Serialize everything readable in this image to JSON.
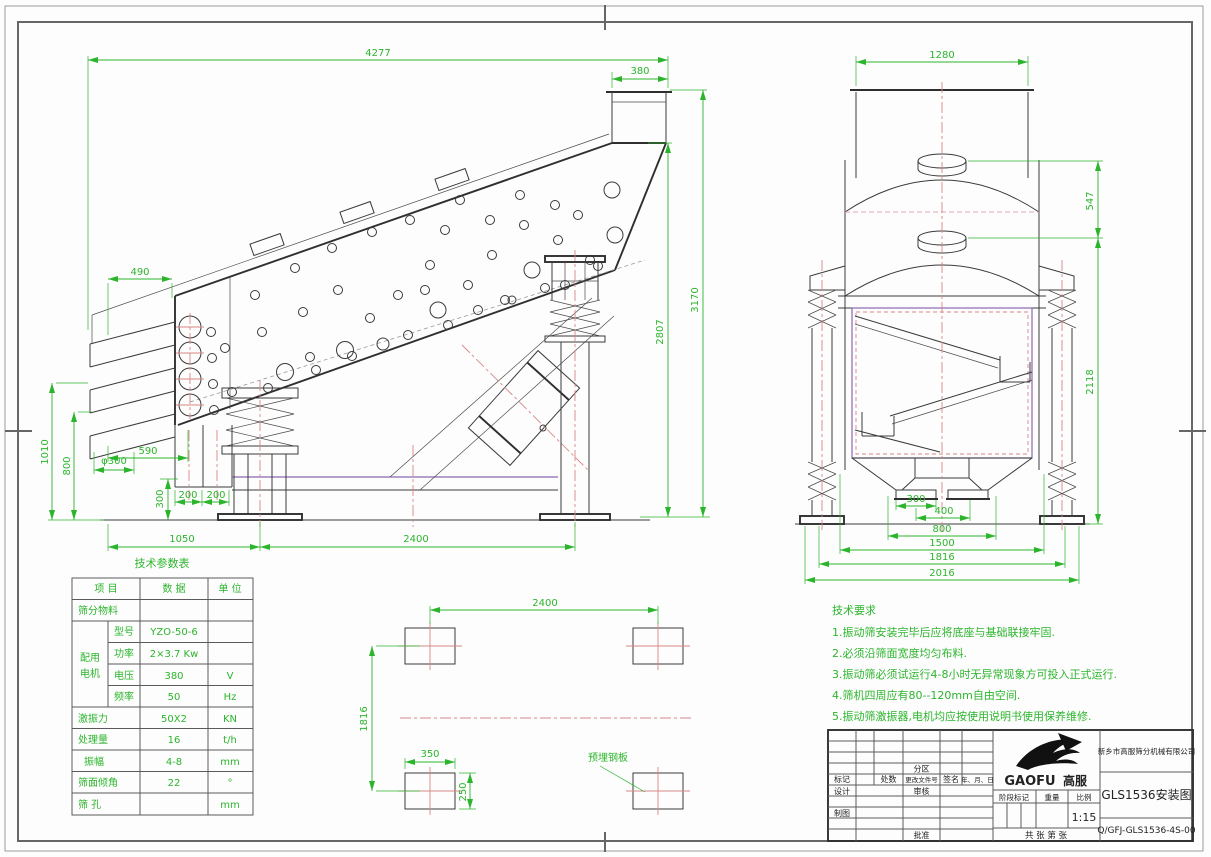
{
  "colors": {
    "dimension_green": "#2cb52c",
    "centerline_red": "#d98686",
    "drawing_line": "#3a3a3a",
    "frame_purple": "#8a6ab0"
  },
  "side_view": {
    "dims": {
      "total": "4277",
      "outlet": "380",
      "d490": "490",
      "d1010": "1010",
      "d800": "800",
      "dphi300": "φ300",
      "d590": "590",
      "d200a": "200",
      "d200b": "200",
      "d300v": "300",
      "d1050": "1050",
      "d2400": "2400",
      "d2807": "2807",
      "d3170": "3170"
    }
  },
  "front_view": {
    "dims": {
      "d1280": "1280",
      "d547": "547",
      "d2118": "2118",
      "d300": "300",
      "d400": "400",
      "d800": "800",
      "d1500": "1500",
      "d1816": "1816",
      "d2016": "2016"
    }
  },
  "plan_view": {
    "label": "预埋钢板",
    "dims": {
      "d2400": "2400",
      "d1816": "1816",
      "d350": "350",
      "d250": "250"
    }
  },
  "params_table": {
    "title": "技术参数表",
    "col_item": "项 目",
    "col_data": "数 据",
    "col_unit": "单 位",
    "row_material": "筛分物料",
    "motor_group_l1": "配用",
    "motor_group_l2": "电机",
    "motor_rows": [
      {
        "label": "型号",
        "value": "YZO-50-6",
        "unit": ""
      },
      {
        "label": "功率",
        "value": "2×3.7 Kw",
        "unit": ""
      },
      {
        "label": "电压",
        "value": "380",
        "unit": "V"
      },
      {
        "label": "频率",
        "value": "50",
        "unit": "Hz"
      }
    ],
    "rows": [
      {
        "label": "激振力",
        "value": "50X2",
        "unit": "KN"
      },
      {
        "label": "处理量",
        "value": "16",
        "unit": "t/h"
      },
      {
        "label": "振幅",
        "value": "4-8",
        "unit": "mm"
      },
      {
        "label": "筛面倾角",
        "value": "22",
        "unit": "°"
      },
      {
        "label": "筛 孔",
        "value": "",
        "unit": "mm"
      }
    ]
  },
  "tech_requirements": {
    "title": "技术要求",
    "items": [
      "1.振动筛安装完毕后应将底座与基础联接牢固.",
      "2.必须沿筛面宽度均匀布料.",
      "3.振动筛必须试运行4-8小时无异常现象方可投入正式运行.",
      "4.筛机四周应有80--120mm自由空间.",
      "5.振动筛激振器,电机均应按使用说明书使用保养维修."
    ]
  },
  "title_block": {
    "company": "新乡市高服筛分机械有限公司",
    "drawing_title": "GLS1536安装图",
    "drawing_no": "Q/GFJ-GLS1536-4S-00",
    "scale_value": "1:15",
    "logo_main": "GAOFU",
    "logo_sub": "高服",
    "labels": {
      "mark": "标记",
      "count": "处数",
      "zone": "分区",
      "change_no": "更改文件号",
      "sign": "签名",
      "date": "年、月、日",
      "design": "设计",
      "audit": "审核",
      "draft": "制图",
      "approve": "批准",
      "stage": "阶段标记",
      "weight": "重量",
      "scale": "比例",
      "sheet": "共  张  第  张"
    }
  }
}
